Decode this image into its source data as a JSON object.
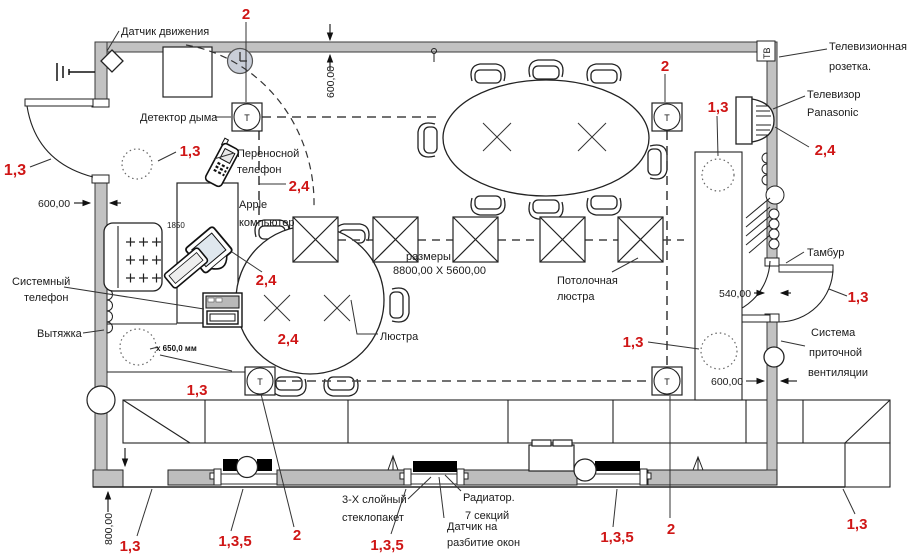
{
  "colors": {
    "wall": "#c2c2c2",
    "window": "#bdbdbd",
    "red_callout": "#cf1616",
    "line": "#1a1a1a",
    "clock_fill": "#c9ced8"
  },
  "labels": {
    "motion_sensor": "Датчик движения",
    "smoke_detector": "Детектор дыма",
    "portable_phone_1": "Переносной",
    "portable_phone_2": "телефон",
    "apple_1": "Apple",
    "apple_2": "компьютер",
    "system_phone_1": "Системный",
    "system_phone_2": "телефон",
    "exhaust": "Вытяжка",
    "exhaust_size": "х 650,0 мм",
    "chandelier": "Люстра",
    "room_size_1": "размеры",
    "room_size_2": "8800,00 X 5600,00",
    "ceiling_chandelier_1": "Потолочная",
    "ceiling_chandelier_2": "люстра",
    "tv_socket_1": "Телевизионная",
    "tv_socket_2": "розетка.",
    "tv_set_1": "Телевизор",
    "tv_set_2": "Panasonic",
    "vestibule": "Тамбур",
    "supply_vent_1": "Система",
    "supply_vent_2": "приточной",
    "supply_vent_3": "вентиляции",
    "glazing_1": "3-Х слойный",
    "glazing_2": "стеклопакет",
    "radiator_1": "Радиатор.",
    "radiator_2": "7 секций",
    "window_sensor_1": "Датчик на",
    "window_sensor_2": "разбитие окон",
    "tv_wall_mark": "ТВ",
    "detector_mark": "Т",
    "desk_dim": "1850"
  },
  "dimensions": {
    "top_offset": "600,00",
    "left_wall": "600,00",
    "sill_height": "800,00",
    "door_width": "540,00",
    "vent_offset": "600,00"
  },
  "callouts": {
    "top_smoke": "2",
    "right_smoke": "2",
    "far_left_door": "1,3",
    "inner_top_left": "1,3",
    "right_top": "1,3",
    "tv": "2,4",
    "right_door": "1,3",
    "right_vent": "1,3",
    "phone": "2,4",
    "imac": "2,4",
    "round_table": "2,4",
    "bottom_left_area": "1,3",
    "bottom_left": "1,3",
    "bottom_rad_1": "1,3,5",
    "bottom_smoke_left": "2",
    "bottom_glazing": "1,3,5",
    "bottom_rad_2": "1,3,5",
    "bottom_smoke_right": "2",
    "bottom_right": "1,3"
  }
}
